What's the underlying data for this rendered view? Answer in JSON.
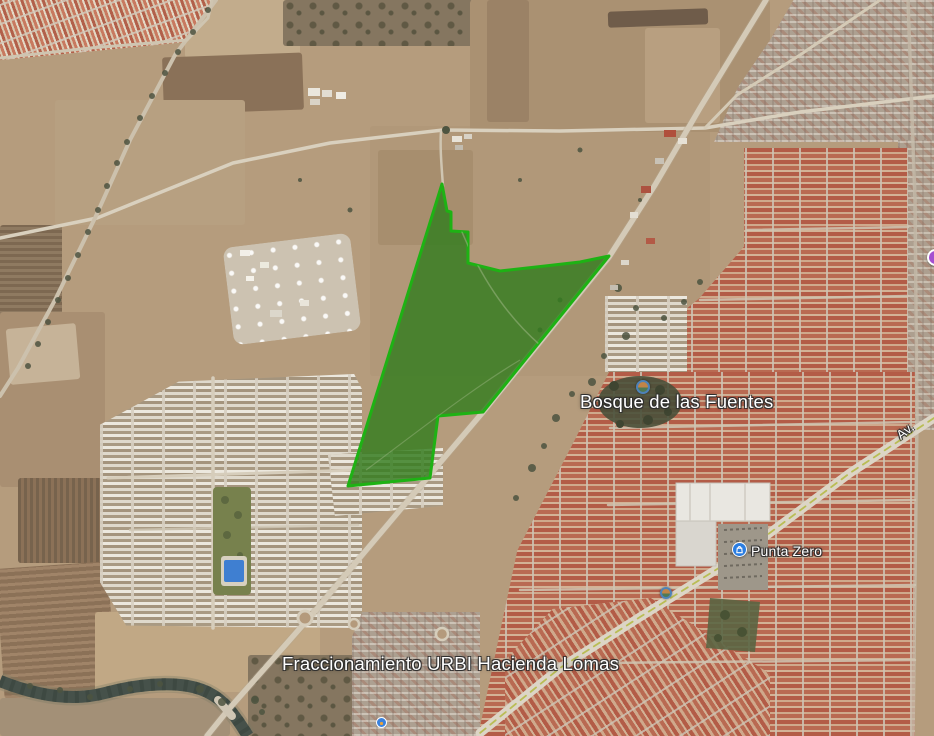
{
  "map": {
    "view": "satellite-imagery",
    "labels": {
      "neighborhood": "Bosque de las Fuentes",
      "store_poi": "Punta Zero",
      "development": "Fraccionamiento URBI Hacienda Lomas",
      "road_partial": "Av."
    },
    "pois": [
      {
        "name": "photo-attraction-bosque",
        "kind": "photo-icon"
      },
      {
        "name": "punta-zero-shopping",
        "kind": "shopping-icon"
      },
      {
        "name": "photo-attraction-small",
        "kind": "photo-icon"
      },
      {
        "name": "edge-poi-purple",
        "kind": "partial-pin"
      },
      {
        "name": "small-blue-poi",
        "kind": "pin"
      }
    ],
    "overlay": {
      "name": "highlighted-parcel",
      "fill": "#337d1e",
      "stroke": "#1eb214",
      "points": "442,184 447,211 451,212 451,231 468,232 468,263 500,271 545,266 580,262 609,256 483,412 438,416 430,478 348,486"
    },
    "colors": {
      "terrain_tan": "#b59c7d",
      "red_roofs": "#b35c47",
      "white_roofs": "#ece8de",
      "river": "#46514a",
      "road": "#d4cab7",
      "avenue_median": "#b9bd55",
      "pool_blue": "#3f7fd1"
    }
  }
}
